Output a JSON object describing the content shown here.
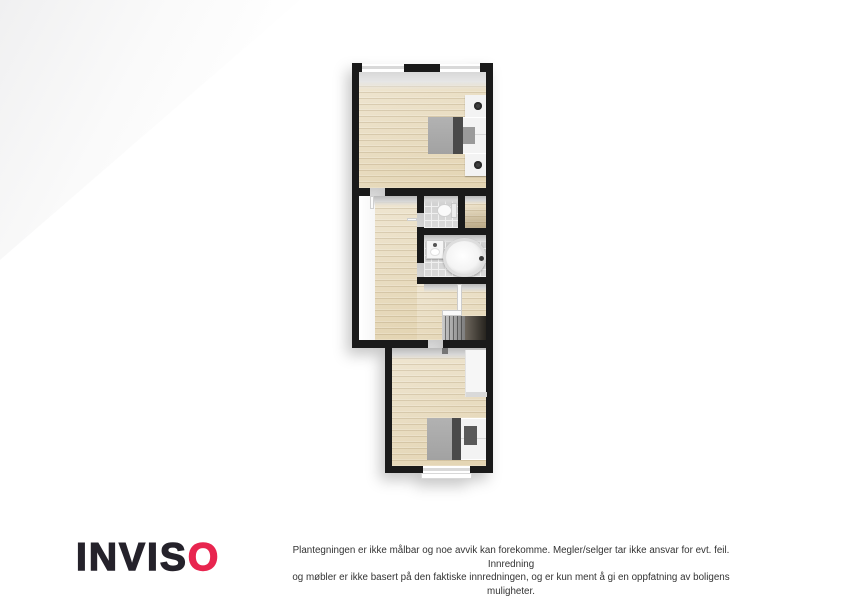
{
  "branding": {
    "logo_text_black": "INVIS",
    "logo_text_accent": "O",
    "accent_color": "#e8254f",
    "logo_color": "#25222b"
  },
  "disclaimer": {
    "line1": "Plantegningen er ikke målbar og noe avvik kan forekomme. Megler/selger tar ikke ansvar for evt. feil. Innredning",
    "line2": "og møbler er ikke basert på den faktiske innredningen, og er kun ment å gi en oppfatning av boligens muligheter."
  },
  "floorplan": {
    "style": "3d-top-down-floorplan",
    "wall_color": "#1a1a1a",
    "wood_floor_color": "#e7dbc0",
    "tile_floor_color": "#d4d4d4",
    "rooms": [
      {
        "name": "bedroom-top",
        "floor": "wood",
        "windows": 2,
        "furniture": [
          "double-bed",
          "nightstand-with-lamp",
          "nightstand-with-lamp"
        ]
      },
      {
        "name": "hallway",
        "floor": "wood",
        "furniture": []
      },
      {
        "name": "wc",
        "floor": "tile",
        "furniture": [
          "toilet"
        ]
      },
      {
        "name": "closet-room",
        "floor": "wood",
        "furniture": []
      },
      {
        "name": "bathroom",
        "floor": "tile",
        "furniture": [
          "sink",
          "round-bathtub"
        ]
      },
      {
        "name": "stair-landing",
        "floor": "wood",
        "furniture": [
          "staircase",
          "railing"
        ]
      },
      {
        "name": "bedroom-bottom",
        "floor": "wood",
        "windows": 1,
        "furniture": [
          "double-bed",
          "wardrobe"
        ]
      }
    ]
  }
}
